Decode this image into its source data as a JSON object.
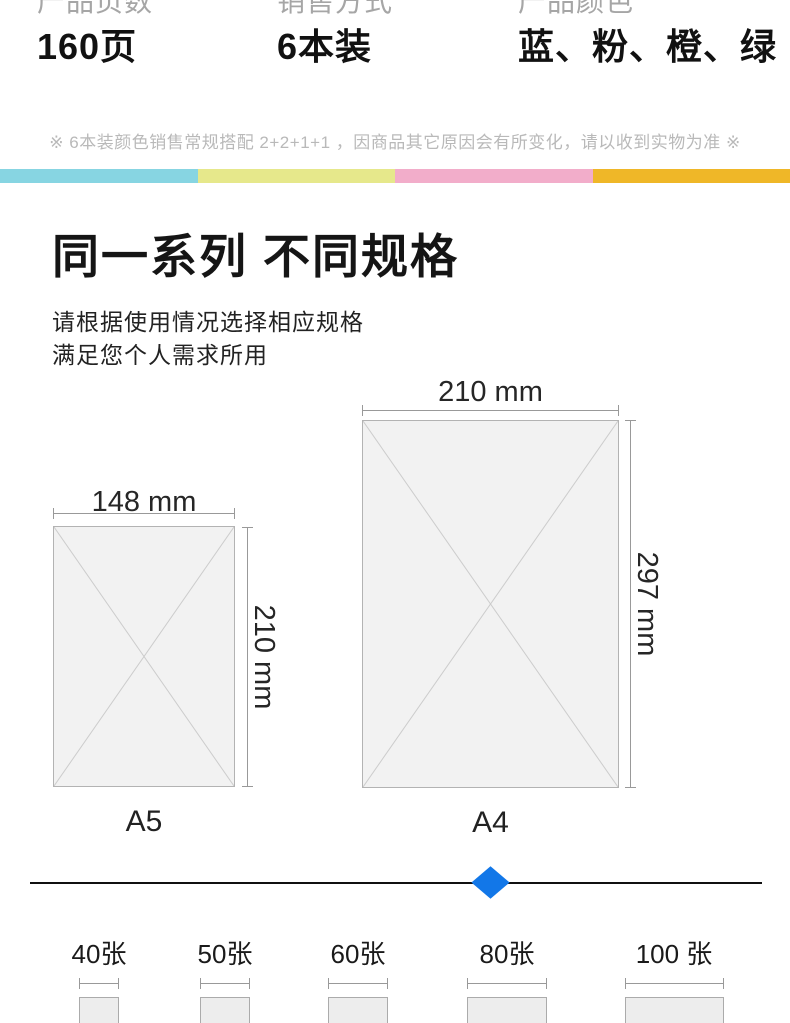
{
  "header": {
    "specs": [
      {
        "label": "产品页数",
        "value": "160页"
      },
      {
        "label": "销售方式",
        "value": "6本装"
      },
      {
        "label": "产品颜色",
        "value": "蓝、粉、橙、绿"
      }
    ],
    "note": "※ 6本装颜色销售常规搭配 2+2+1+1 ，因商品其它原因会有所变化，请以收到实物为准 ※"
  },
  "stripe": {
    "colors": [
      "#87d5e2",
      "#e6e88b",
      "#f2adca",
      "#efb728"
    ]
  },
  "section": {
    "title": "同一系列 不同规格",
    "subtitle_line1": "请根据使用情况选择相应规格",
    "subtitle_line2": "满足您个人需求所用"
  },
  "paper_sizes": [
    {
      "name": "A5",
      "width_label": "148 mm",
      "height_label": "210 mm"
    },
    {
      "name": "A4",
      "width_label": "210 mm",
      "height_label": "297 mm"
    }
  ],
  "divider": {
    "diamond_color": "#1277e8"
  },
  "sheet_options": [
    {
      "label": "40张"
    },
    {
      "label": "50张"
    },
    {
      "label": "60张"
    },
    {
      "label": "80张"
    },
    {
      "label": "100 张"
    }
  ]
}
